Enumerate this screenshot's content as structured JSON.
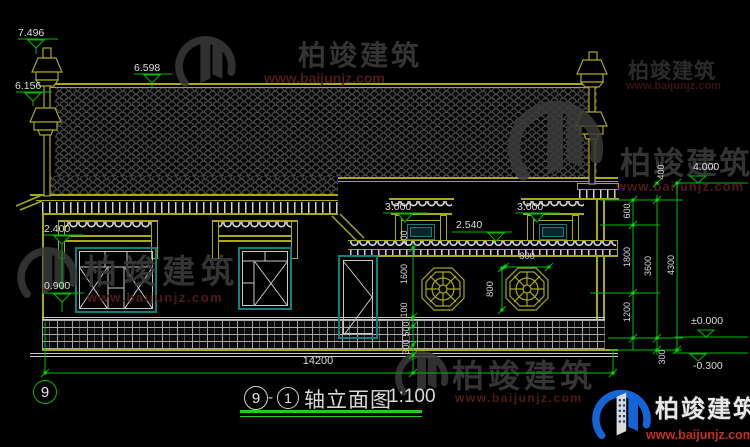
{
  "watermark": {
    "brand": "柏竣建筑",
    "url": "www.baijunjz.com"
  },
  "elevations": {
    "e7496": "7.496",
    "e6598": "6.598",
    "e6156": "6.156",
    "e2400": "2.400",
    "e0900": "0.900",
    "e3000": "3.000",
    "e2540": "2.540",
    "e4000": "4.000",
    "e0000": "±0.000",
    "em0300": "-0.300"
  },
  "dims": {
    "d400": "400",
    "d600": "600",
    "d1800": "1800",
    "d1200": "1200",
    "d3600": "3600",
    "d4300": "4300",
    "d300": "300",
    "d100": "100",
    "d1600": "1600",
    "d500": "500",
    "d800": "800",
    "d14200": "14200"
  },
  "axis": {
    "bubble": "9"
  },
  "title": {
    "axis_a": "9",
    "separator": "-",
    "axis_b": "1",
    "name": "轴立面图",
    "scale": "1:100"
  }
}
